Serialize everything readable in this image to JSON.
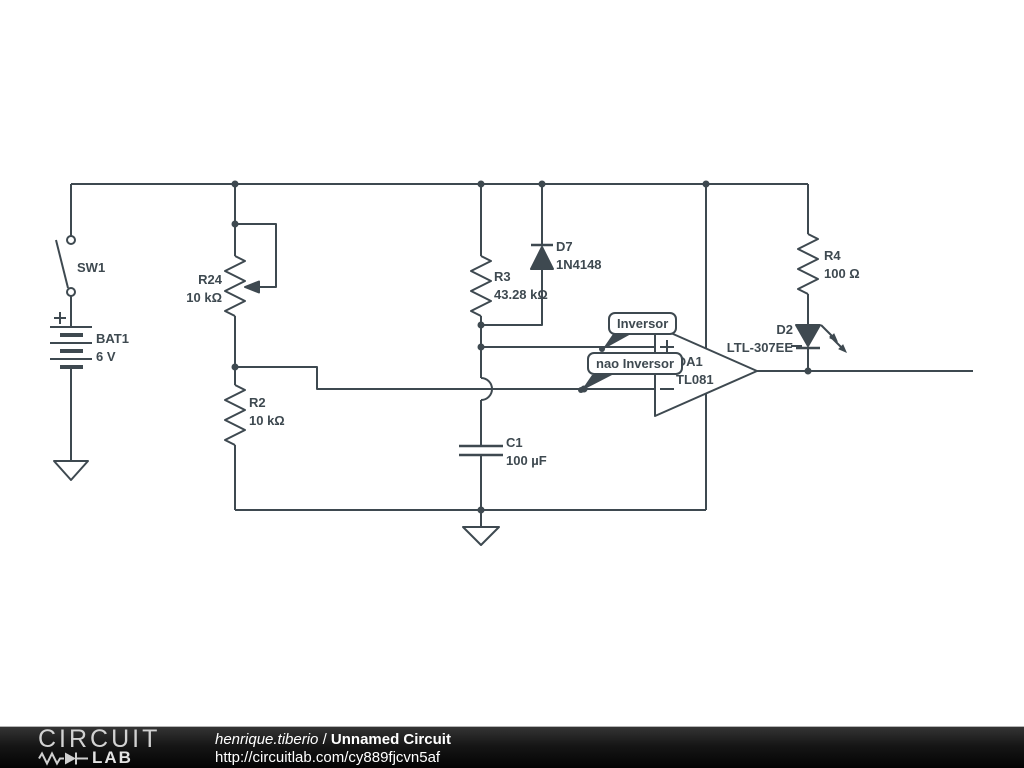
{
  "circuit": {
    "components": {
      "sw1": {
        "label": "SW1",
        "value": ""
      },
      "bat1": {
        "label": "BAT1",
        "value": "6 V"
      },
      "r24": {
        "label": "R24",
        "value": "10 kΩ"
      },
      "r2": {
        "label": "R2",
        "value": "10 kΩ"
      },
      "r3": {
        "label": "R3",
        "value": "43.28 kΩ"
      },
      "d7": {
        "label": "D7",
        "value": "1N4148"
      },
      "c1": {
        "label": "C1",
        "value": "100 µF"
      },
      "oa1": {
        "label": "OA1",
        "value": "TL081"
      },
      "r4": {
        "label": "R4",
        "value": "100 Ω"
      },
      "d2": {
        "label": "D2",
        "value": "LTL-307EE"
      }
    },
    "annotations": {
      "inverting_label": "Inversor",
      "noninverting_label": "nao Inversor"
    },
    "colors": {
      "wire": "#3e4950",
      "background": "#ffffff"
    }
  },
  "footer": {
    "logo_top": "CIRCUIT",
    "logo_bottom": "LAB",
    "author": "henrique.tiberio",
    "separator": " / ",
    "title": "Unnamed Circuit",
    "url": "http://circuitlab.com/cy889fjcvn5af",
    "bg_color": "#161616",
    "text_color": "#ffffff"
  }
}
